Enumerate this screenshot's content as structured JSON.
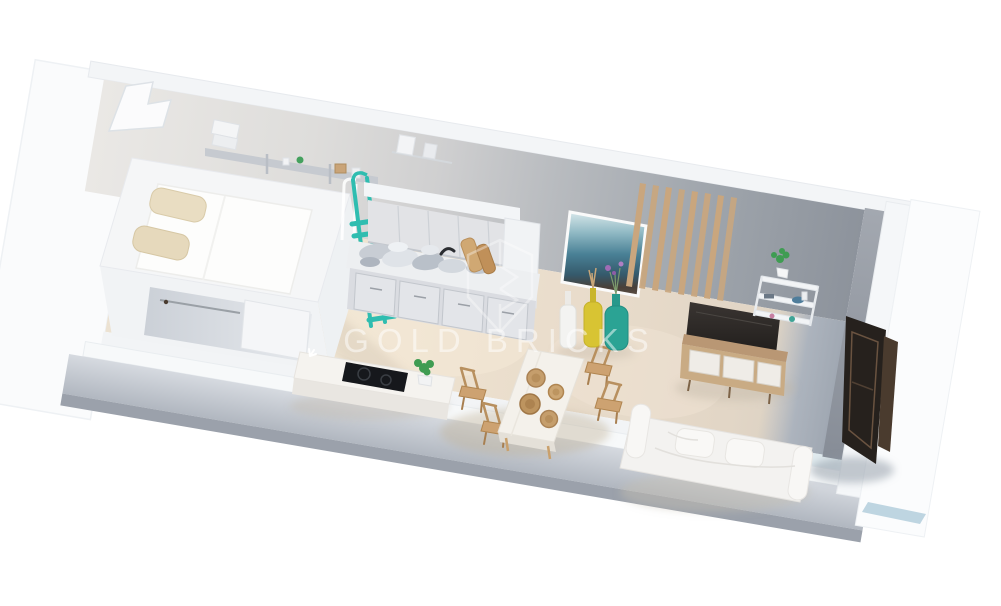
{
  "page": {
    "background": "#ffffff",
    "description": "3D isometric render of a studio apartment floor plan viewed from above at an angle, on a plain white background"
  },
  "watermark": {
    "brand": "GOLD BRICKS",
    "logo": "shield-crest-outline",
    "color": "#ffffff"
  },
  "colors": {
    "accent_teal": "#2fbdb0",
    "floor_beige": "#eadfcd",
    "entry_floor_gray": "#9aa2af",
    "wall_white": "#f5f6f8",
    "wall_gray": "#9aa0a8",
    "wood": "#c9a67e",
    "dark_fixture": "#26211d",
    "sofa_white": "#f4f3f1",
    "painting_blue": "#4f89a0",
    "vase_yellow": "#d8c433",
    "vase_teal": "#2ba394",
    "plant_green": "#3f9c52",
    "cooktop_black": "#16181c"
  },
  "scene": {
    "view": "isometric-top-down",
    "areas": [
      "sleeping-loft",
      "closet-under-loft",
      "kitchen",
      "dining-area",
      "living-area",
      "entry"
    ],
    "furniture": [
      "loft-bed-mattress",
      "bed-pillows",
      "wall-shelf-with-books",
      "teal-ladder",
      "kitchen-upper-cabinets",
      "kitchen-counter",
      "kitchen-lower-cabinets",
      "tall-cabinet",
      "kitchen-island-cooktop",
      "potted-plant",
      "dining-table",
      "dining-chairs",
      "rattan-plates",
      "abstract-wall-art",
      "decorative-floor-vases",
      "wood-slat-wall-panel",
      "tv-screen",
      "tv-console",
      "wall-shelf-decor",
      "white-sofa",
      "dark-entry-wardrobe"
    ]
  }
}
